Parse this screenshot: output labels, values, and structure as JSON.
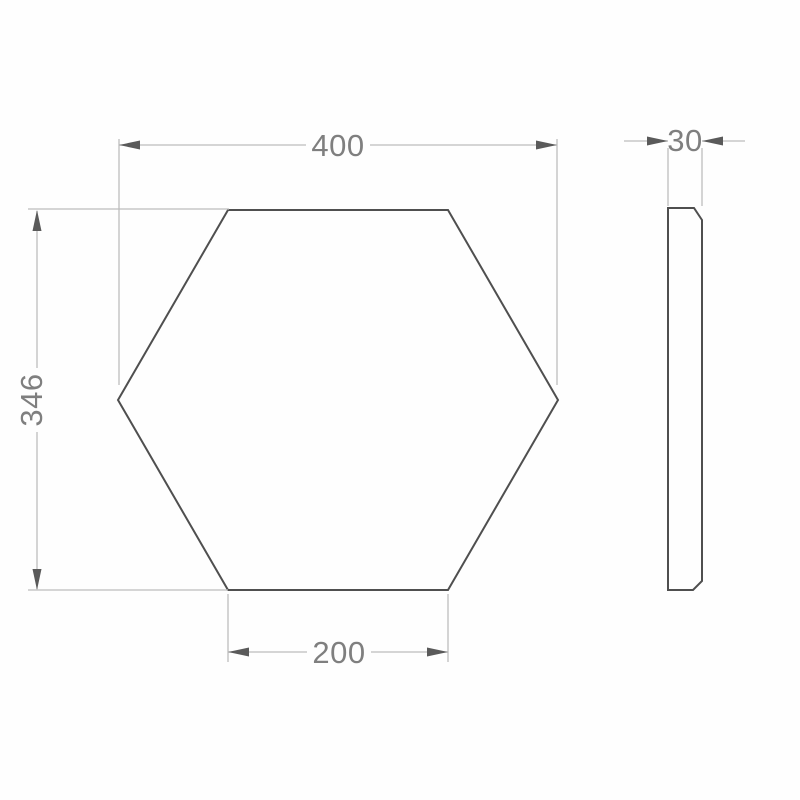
{
  "drawing": {
    "dimensions": {
      "width": "400",
      "height": "346",
      "bottom_edge": "200",
      "thickness": "30"
    },
    "colors": {
      "background": "#fefefe",
      "outline": "#4f4f4f",
      "dimension_line": "#bdbdbd",
      "arrowhead": "#5a5a5a",
      "label_text": "#7f7f7f"
    }
  }
}
